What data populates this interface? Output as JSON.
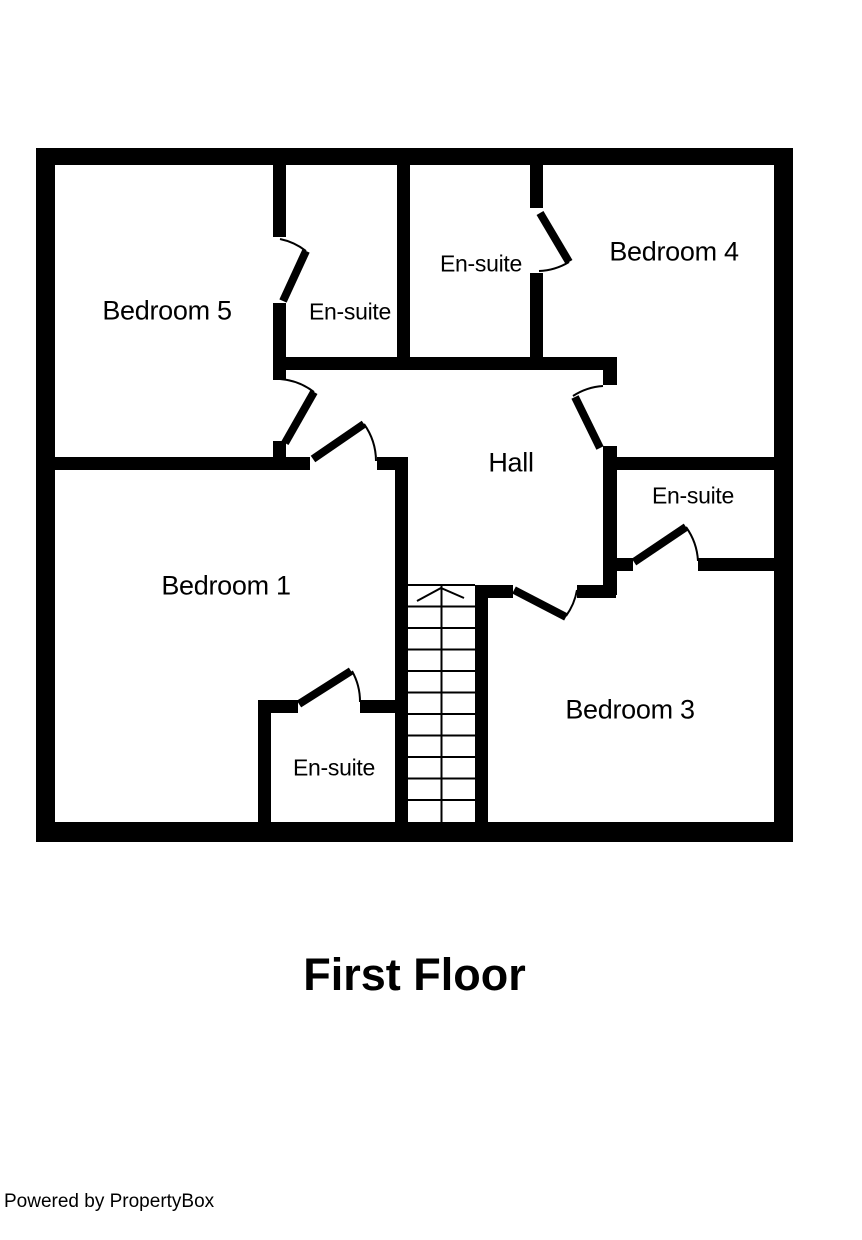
{
  "title": "First Floor",
  "footer": "Powered by PropertyBox",
  "colors": {
    "wall": "#000000",
    "background": "#ffffff",
    "text": "#000000"
  },
  "stairs": {
    "direction_arrow": "up",
    "rows": 11
  },
  "rooms": [
    {
      "id": "bedroom5",
      "label": "Bedroom 5"
    },
    {
      "id": "ensuite-bedroom5",
      "label": "En-suite"
    },
    {
      "id": "ensuite-bedroom4",
      "label": "En-suite"
    },
    {
      "id": "bedroom4",
      "label": "Bedroom 4"
    },
    {
      "id": "hall",
      "label": "Hall"
    },
    {
      "id": "ensuite-bedroom3",
      "label": "En-suite"
    },
    {
      "id": "bedroom1",
      "label": "Bedroom 1"
    },
    {
      "id": "bedroom3",
      "label": "Bedroom 3"
    },
    {
      "id": "ensuite-bedroom1",
      "label": "En-suite"
    }
  ]
}
